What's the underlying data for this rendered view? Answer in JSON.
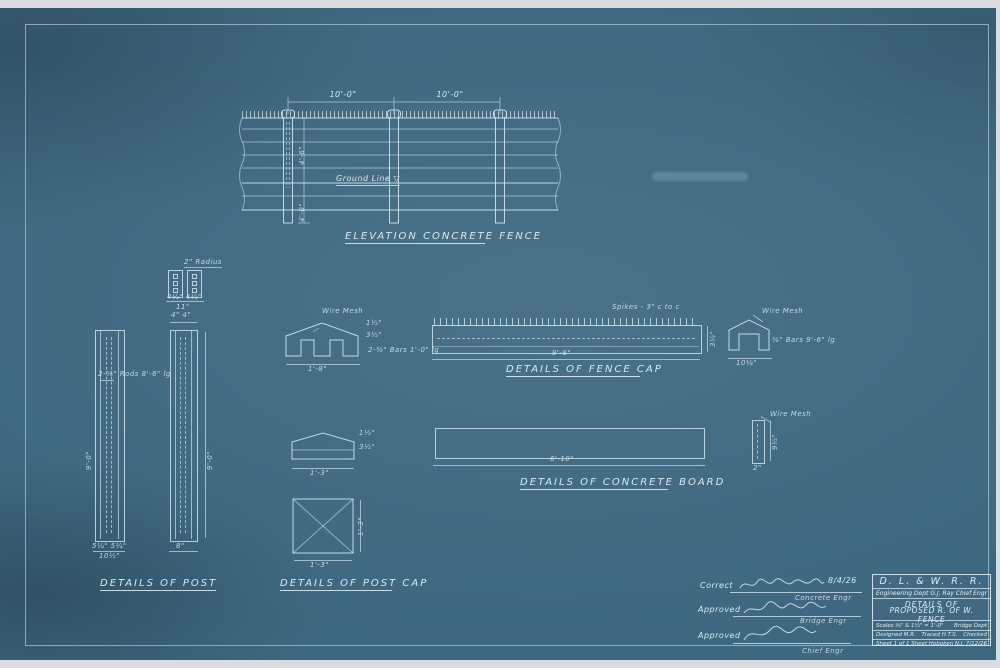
{
  "elevation": {
    "caption": "ELEVATION CONCRETE FENCE",
    "span_dim_1": "10'-0\"",
    "span_dim_2": "10'-0\"",
    "ground_line": "Ground Line ▽",
    "height_above": "4'-6\"",
    "depth_below": "4'-0\""
  },
  "post": {
    "caption": "DETAILS OF POST",
    "radius_label": "2\" Radius",
    "section_dims": "4¼\"   4¼\"",
    "section_total": "11\"",
    "rods_label": "2-⅝\" Rods 8'-6\" lg",
    "left_height": "9'-0\"",
    "right_height": "9'-0\"",
    "right_top_dims": "4\"  4\"",
    "left_bottom_dims": "5¼\" 5¼\"",
    "left_bottom_total": "10½\"",
    "right_bottom_total": "8\""
  },
  "post_cap": {
    "caption": "DETAILS OF POST CAP",
    "wire_mesh": "Wire Mesh",
    "bars_label": "2-⅜\" Bars 1'-0\" lg",
    "front_width": "1'-8\"",
    "side_dim_top": "1½\"",
    "side_dim_bottom": "3½\"",
    "side_width": "1'-3\"",
    "plan_width": "1'-3\"",
    "plan_height": "1'-3\""
  },
  "fence_cap": {
    "caption": "DETAILS OF FENCE CAP",
    "spikes_label": "Spikes - 3\" c to c",
    "length": "9'-8\"",
    "depth": "3½\"",
    "wire_mesh": "Wire Mesh",
    "bars_label": "⅜\" Bars 9'-6\" lg",
    "section_width": "10¼\""
  },
  "board": {
    "caption": "DETAILS OF CONCRETE BOARD",
    "length": "6'-10\"",
    "wire_mesh": "Wire Mesh",
    "section_height": "9½\"",
    "section_width": "2\""
  },
  "signatures": {
    "rows": [
      {
        "prefix": "Correct",
        "date": "8/4/26",
        "role": "Concrete Engr"
      },
      {
        "prefix": "Approved",
        "date": "",
        "role": "Bridge Engr"
      },
      {
        "prefix": "Approved",
        "date": "",
        "role": "Chief Engr"
      }
    ]
  },
  "title_block": {
    "railroad": "D. L. & W. R. R.",
    "dept": "Engineering Dept",
    "chief_engr": "G.J. Ray Chief Engr",
    "subject_line1": "DETAILS OF",
    "subject_line2": "PROPOSED R. OF W. FENCE",
    "scales": "Scales ⅜\" & 1½\" = 1'-0\"",
    "office": "Bridge Dept",
    "designed": "Designed M.R.",
    "traced": "Traced H.T.S.",
    "checked": "Checked",
    "sheet": "Sheet 1 of 1 Sheet",
    "location": "Hoboken N.J.",
    "date": "7/12/26"
  }
}
